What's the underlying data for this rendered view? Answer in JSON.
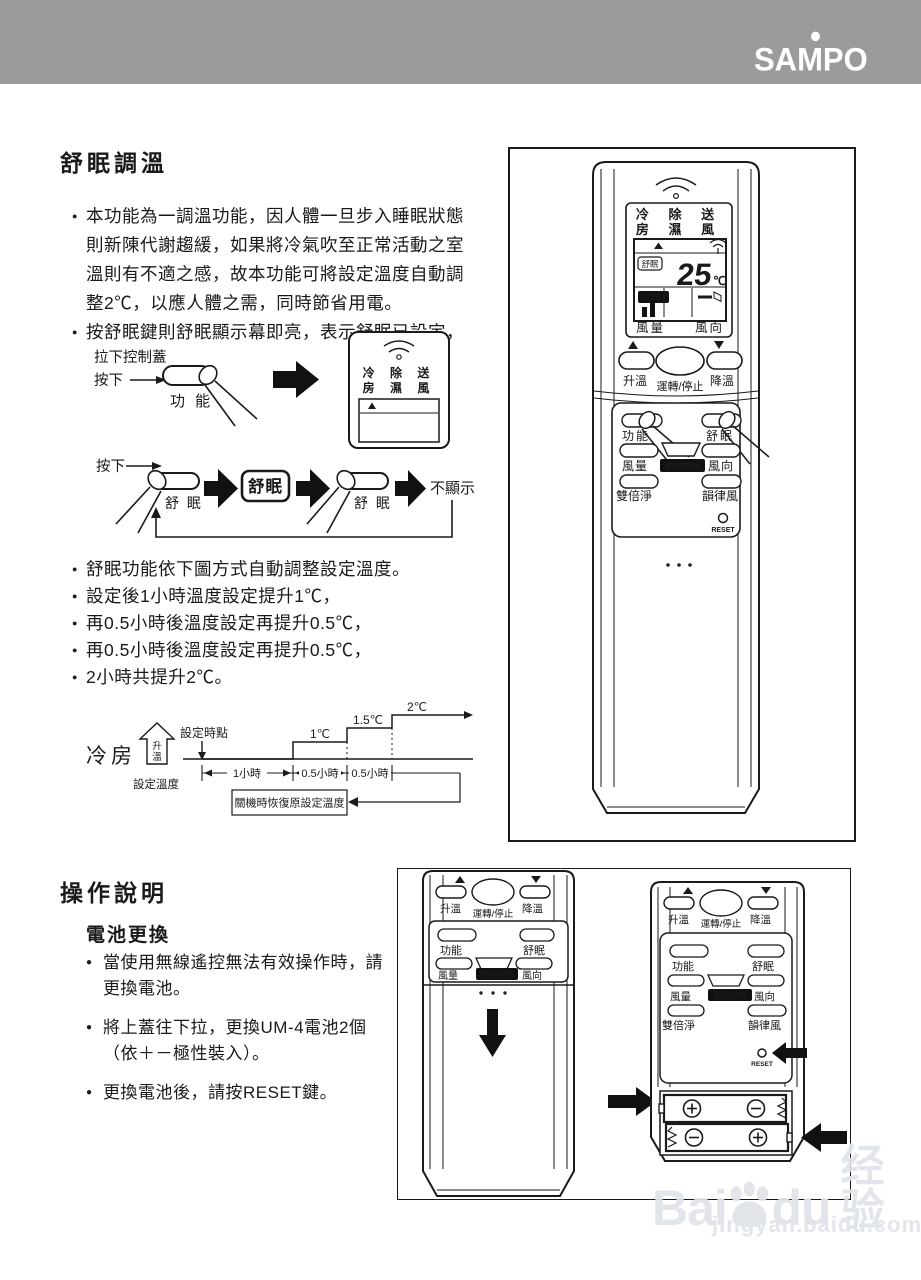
{
  "header": {
    "brand": "SAMPO"
  },
  "sleep": {
    "title": "舒眠調溫",
    "bullet1_lines": [
      "本功能為一調溫功能，因人體一旦步入睡眠狀態",
      "則新陳代謝趨緩，如果將冷氣吹至正常活動之室",
      "溫則有不適之感，故本功能可將設定溫度自動調",
      "整2℃，以應人體之需，同時節省用電。"
    ],
    "bullet2": "按舒眠鍵則舒眠顯示幕即亮，表示舒眠已設定，",
    "flow": {
      "pull": "拉下控制蓋",
      "press": "按下",
      "func": "功 能",
      "press2": "按下",
      "sleep1": "舒 眠",
      "badge": "舒眠",
      "sleep2": "舒 眠",
      "hide": "不顯示",
      "mode1": "冷 除 送",
      "mode2": "房 濕 風"
    },
    "bullets2": [
      "舒眠功能依下圖方式自動調整設定溫度。",
      "設定後1小時溫度設定提升1℃，",
      "再0.5小時後溫度設定再提升0.5℃，",
      "再0.5小時後溫度設定再提升0.5℃，",
      "2小時共提升2℃。"
    ],
    "chart": {
      "type": "step",
      "mode": "冷房",
      "rise_top": "升",
      "rise_bottom": "溫",
      "set_temp": "設定溫度",
      "set_point": "設定時點",
      "intervals": [
        "1小時",
        "0.5小時",
        "0.5小時"
      ],
      "levels": [
        "1℃",
        "1.5℃",
        "2℃"
      ],
      "note": "關機時恢復原設定溫度"
    }
  },
  "remote": {
    "mode1": "冷 除 送",
    "mode2": "房 濕 風",
    "sleep_badge": "舒眠",
    "temp": "25",
    "unit": "℃",
    "fuzzy": "FUZZY",
    "fan": "風量",
    "vane": "風向",
    "up": "升溫",
    "run": "運轉/停止",
    "down": "降溫",
    "func": "功能",
    "sleep": "舒眠",
    "timer": "預約定時",
    "purify": "雙倍淨",
    "rhythm": "韻律風",
    "reset": "RESET"
  },
  "operation": {
    "title": "操作說明",
    "subtitle": "電池更換",
    "bullets": [
      [
        "當使用無線遙控無法有效操作時，請",
        "更換電池。"
      ],
      [
        "將上蓋往下拉，更換UM-4電池2個",
        "（依＋－極性裝入）。"
      ],
      [
        "更換電池後，請按RESET鍵。"
      ]
    ]
  },
  "battery": {
    "up": "升溫",
    "run": "運轉/停止",
    "down": "降溫",
    "func": "功能",
    "sleep": "舒眠",
    "fan": "風量",
    "timer": "預約定時",
    "vane": "風向",
    "purify": "雙倍淨",
    "rhythm": "韻律風",
    "reset": "RESET",
    "polarity": [
      [
        "+",
        "−"
      ],
      [
        "−",
        "+"
      ]
    ]
  },
  "watermark": {
    "brand_a": "Bai",
    "brand_b": "du",
    "cn": "经验",
    "url": "jingyan.baidu.com"
  }
}
